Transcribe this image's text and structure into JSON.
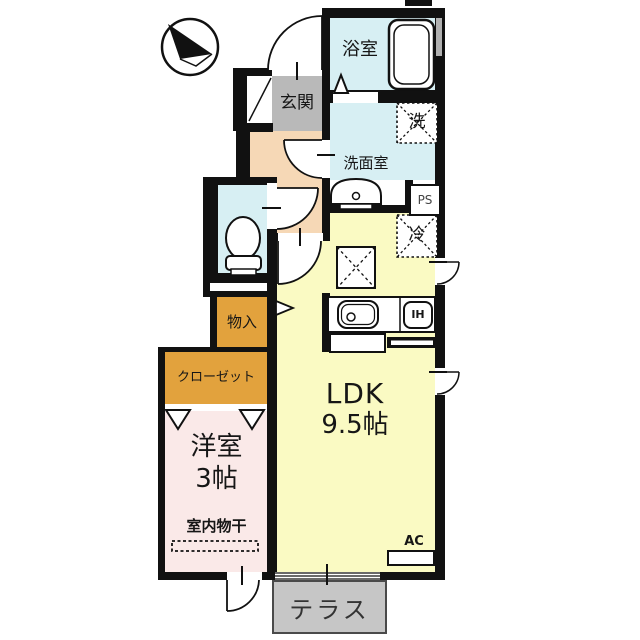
{
  "floorplan": {
    "title": "1K apartment floor plan",
    "compass": {
      "icon": "north-arrow"
    },
    "labels": {
      "bathroom": "浴室",
      "washroom": "洗面室",
      "washer": "洗",
      "pipe_space": "PS",
      "fridge": "冷",
      "entrance": "玄関",
      "storage": "物入",
      "closet": "クローゼット",
      "western_room": "洋室",
      "western_room_size": "3帖",
      "indoor_drying": "室内物干",
      "ldk": "LDK",
      "ldk_size": "9.5帖",
      "ac": "AC",
      "ih": "IH",
      "terrace": "テラス"
    },
    "colors": {
      "wet_area_floor": "#d7eff3",
      "hallway_floor": "#f6d8b6",
      "ldk_floor": "#fafac3",
      "western_room_floor": "#fae9e8",
      "storage_fill": "#e2a23d",
      "entrance_floor": "#b9b9b9",
      "terrace_fill": "#c6c6c6",
      "wall": "#111111"
    }
  }
}
